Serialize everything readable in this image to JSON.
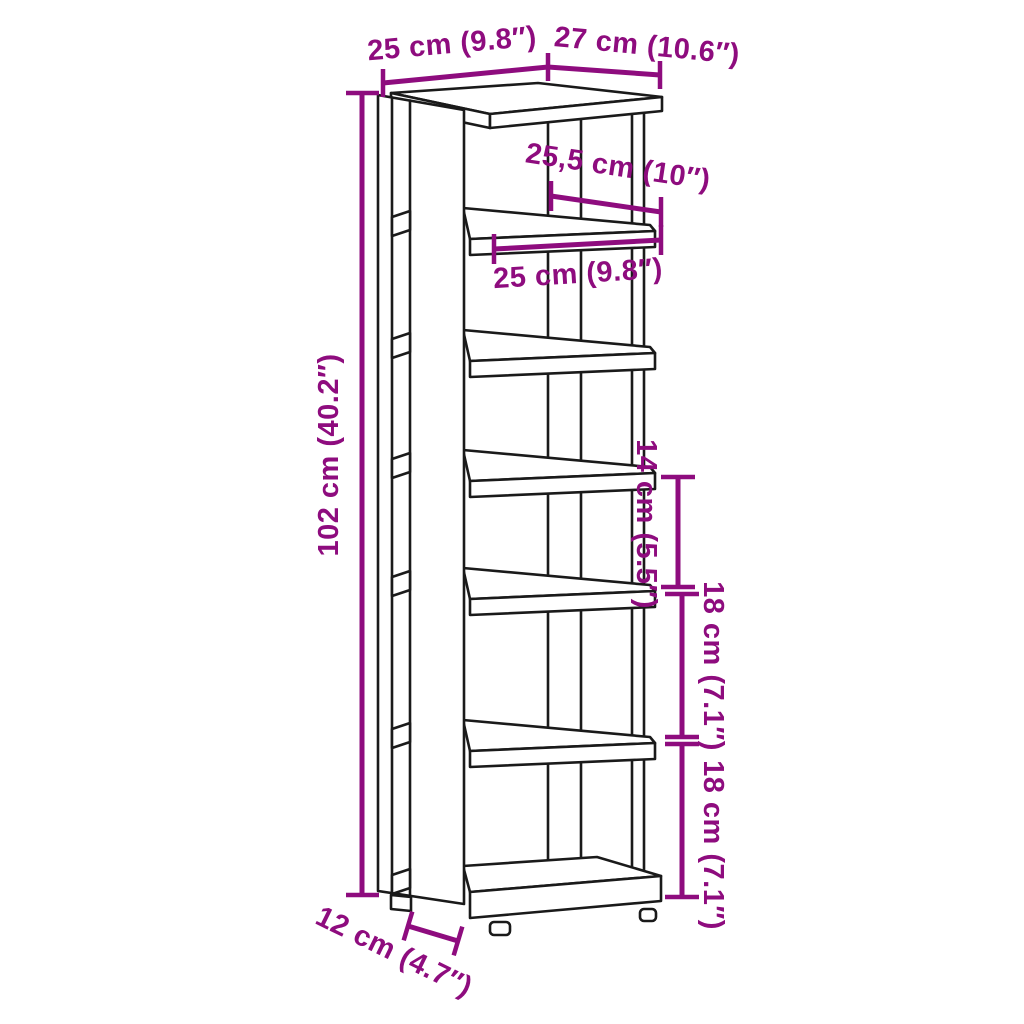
{
  "diagram": {
    "type": "product-dimension-line-drawing",
    "subject": "tall narrow shoe rack with tall side panel, top board and six stacked shelves on support posts",
    "colors": {
      "dimension_annotation": "#8E0C7E",
      "drawing_outline": "#1a1a1a",
      "background": "#FFFFFF"
    },
    "labels": {
      "top_width": "25 cm (9.8″)",
      "top_depth": "27 cm (10.6″)",
      "shelf_depth": "25,5 cm (10″)",
      "shelf_width": "25 cm (9.8″)",
      "overall_height": "102 cm (40.2″)",
      "shelf_gap_top": "14 cm (5.5″)",
      "shelf_gap_middle": "18 cm (7.1″)",
      "shelf_gap_bottom": "18 cm (7.1″)",
      "side_panel_depth": "12 cm (4.7″)"
    }
  }
}
